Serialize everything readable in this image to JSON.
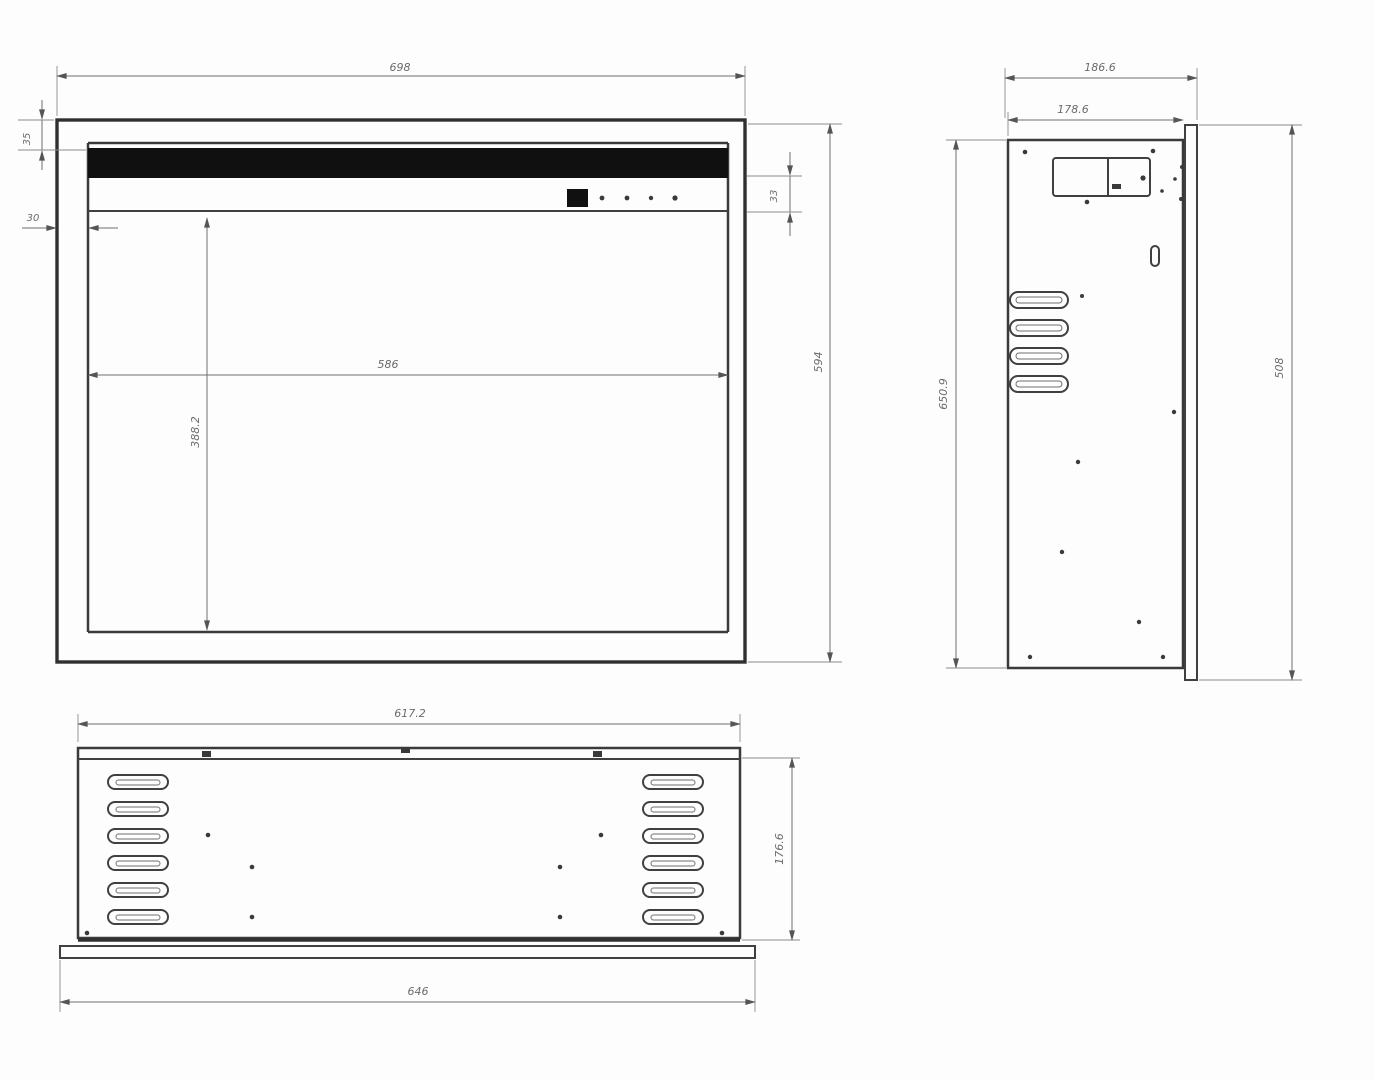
{
  "drawing": {
    "description": "three-view technical dimension drawing of electric fireplace insert",
    "front_view": {
      "overall_width": "698",
      "overall_height": "594",
      "opening_width": "586",
      "opening_height": "388.2",
      "top_frame_height": "35",
      "side_frame_width": "30",
      "control_band_height": "33"
    },
    "side_view": {
      "overall_depth": "186.6",
      "body_depth": "178.6",
      "body_height": "650.9",
      "overall_height": "508"
    },
    "bottom_view": {
      "body_width": "617.2",
      "body_depth": "176.6",
      "overall_width": "646"
    },
    "colors": {
      "line": "#3a3a3a",
      "dimension_line": "#6f6f6f",
      "text": "#6b6b6b",
      "solid_fill": "#101010",
      "background": "#fdfdfd"
    }
  }
}
